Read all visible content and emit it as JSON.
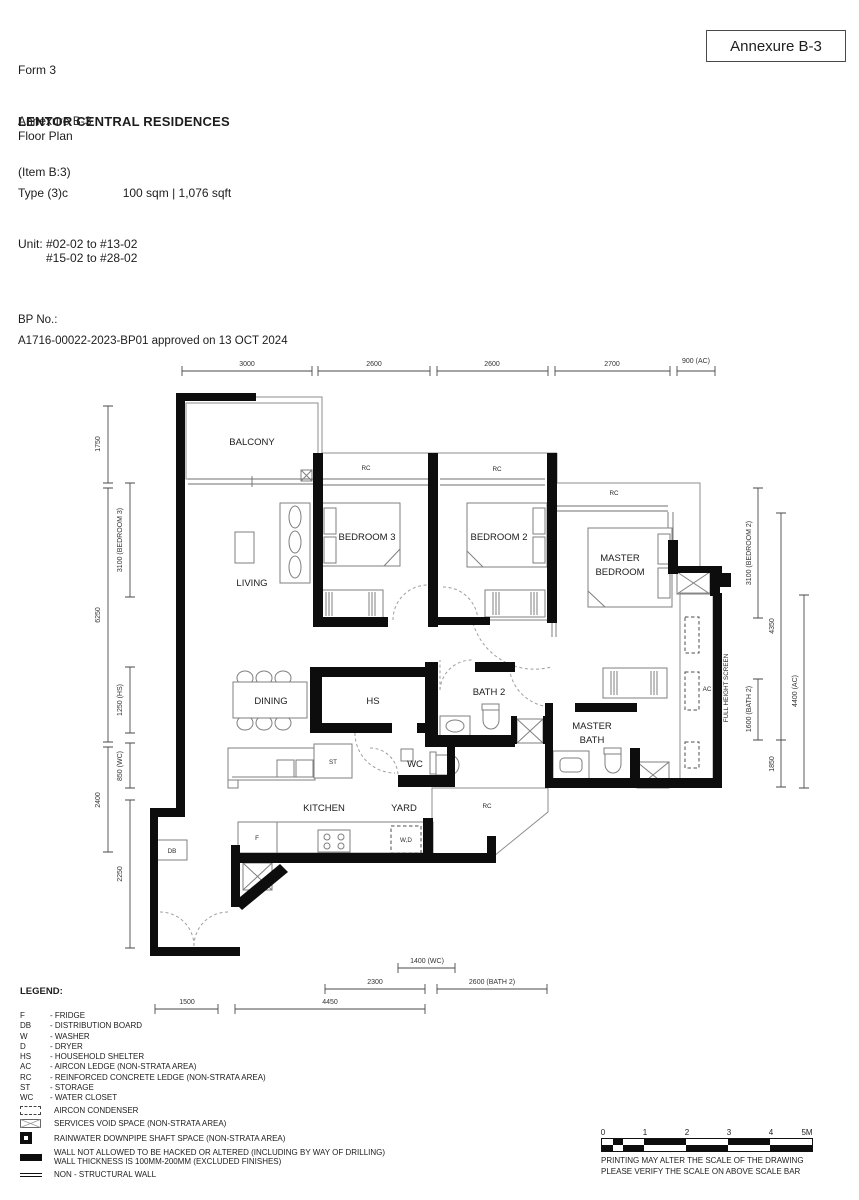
{
  "doc": {
    "form_line1": "Form 3",
    "form_line2": "Annexure B-3",
    "form_line3": "(Item B:3)",
    "annexure_box": "Annexure B-3",
    "title": "LENTOR CENTRAL RESIDENCES",
    "subtitle": "Floor Plan",
    "type_label": "Type (3)c",
    "area_text": "100 sqm | 1,076 sqft",
    "unit_label": "Unit:",
    "unit_line1": "#02-02 to #13-02",
    "unit_line2": "#15-02 to #28-02",
    "bp_label": "BP No.:",
    "bp_text": "A1716-00022-2023-BP01 approved on 13 OCT 2024"
  },
  "plan": {
    "rooms": {
      "balcony": "BALCONY",
      "living": "LIVING",
      "bedroom3": "BEDROOM 3",
      "bedroom2": "BEDROOM 2",
      "master_l1": "MASTER",
      "master_l2": "BEDROOM",
      "dining": "DINING",
      "hs": "HS",
      "bath2": "BATH 2",
      "mbath_l1": "MASTER",
      "mbath_l2": "BATH",
      "wc": "WC",
      "kitchen": "KITCHEN",
      "yard": "YARD"
    },
    "ann": {
      "rc": "RC",
      "ac": "AC",
      "st": "ST",
      "db": "DB",
      "f": "F",
      "wd": "W,D",
      "fhs": "FULL HEIGHT SCREEN"
    },
    "dims": {
      "top": [
        "3000",
        "2600",
        "2600",
        "2700",
        "900 (AC)"
      ],
      "left_outer": [
        "1750",
        "6250",
        "2400"
      ],
      "left_inner": [
        "3100 (BEDROOM 3)",
        "1250 (HS)",
        "850 (WC)",
        "2250"
      ],
      "right_col1": [
        "3100 (BEDROOM 2)",
        "1600 (BATH 2)"
      ],
      "right_col2": [
        "4350",
        "1850"
      ],
      "right_col3": [
        "4400 (AC)"
      ],
      "bottom": [
        "1400 (WC)",
        "2300",
        "2600 (BATH 2)",
        "1500",
        "4450"
      ]
    }
  },
  "legend": {
    "title": "LEGEND:",
    "items": [
      {
        "abbr": "F",
        "desc": "- FRIDGE"
      },
      {
        "abbr": "DB",
        "desc": "- DISTRIBUTION BOARD"
      },
      {
        "abbr": "W",
        "desc": "- WASHER"
      },
      {
        "abbr": "D",
        "desc": "- DRYER"
      },
      {
        "abbr": "HS",
        "desc": "- HOUSEHOLD SHELTER"
      },
      {
        "abbr": "AC",
        "desc": "- AIRCON LEDGE (NON-STRATA AREA)"
      },
      {
        "abbr": "RC",
        "desc": "- REINFORCED CONCRETE LEDGE (NON-STRATA AREA)"
      },
      {
        "abbr": "ST",
        "desc": "- STORAGE"
      },
      {
        "abbr": "WC",
        "desc": "- WATER CLOSET"
      }
    ],
    "symbols": [
      {
        "label": "AIRCON CONDENSER"
      },
      {
        "label": "SERVICES VOID SPACE (NON-STRATA AREA)"
      },
      {
        "label": "RAINWATER DOWNPIPE SHAFT SPACE (NON-STRATA AREA)"
      },
      {
        "label": "WALL NOT ALLOWED TO BE HACKED OR ALTERED (INCLUDING BY WAY OF DRILLING)",
        "label2": "WALL THICKNESS IS 100MM-200MM (EXCLUDED FINISHES)"
      },
      {
        "label": "NON - STRUCTURAL WALL"
      }
    ]
  },
  "scalebar": {
    "ticks": [
      "0",
      "1",
      "2",
      "3",
      "4",
      "5M"
    ],
    "note1": "PRINTING MAY ALTER THE SCALE OF THE DRAWING",
    "note2": "PLEASE VERIFY THE SCALE ON ABOVE SCALE BAR"
  }
}
